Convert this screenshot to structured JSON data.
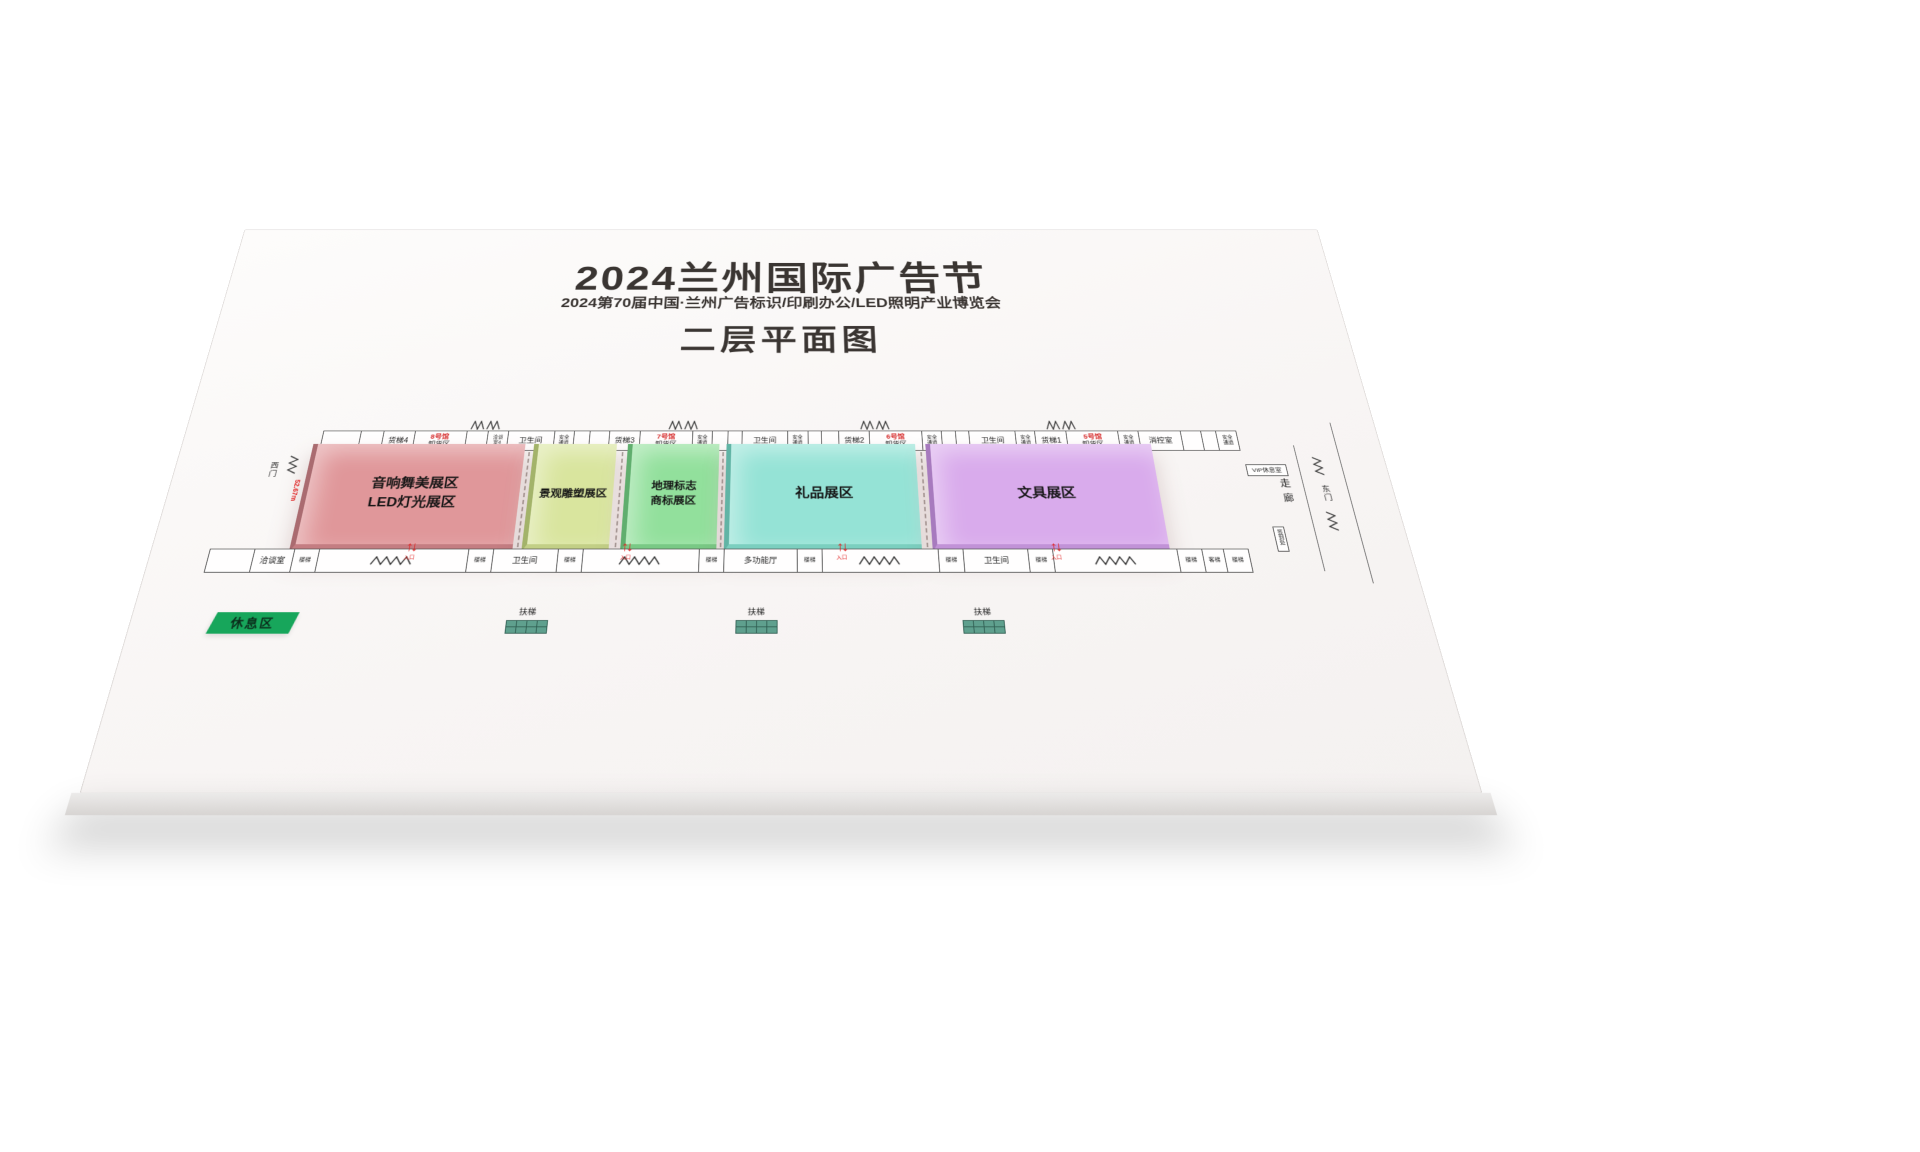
{
  "header": {
    "title": "2024兰州国际广告节",
    "subtitle": "2024第70届中国·兰州广告标识/印刷办公/LED照明产业博览会",
    "plan_title": "二层平面图"
  },
  "colors": {
    "hall_audio_red": "#e0979a",
    "hall_sculpture_yellow_green": "#d9e59e",
    "hall_geo_green": "#92e09c",
    "hall_gift_cyan": "#95e3d6",
    "hall_stationery_purple": "#d9abec",
    "accent_red": "#d62b2b",
    "rest_badge_green": "#17a65b",
    "escalator_teal": "#5fa08e",
    "board_white": "#fbf9f8"
  },
  "halls": [
    {
      "name_line1": "音响舞美展区",
      "name_line2": "LED灯光展区"
    },
    {
      "name_line1": "景观雕塑展区",
      "name_line2": ""
    },
    {
      "name_line1": "地理标志",
      "name_line2": "商标展区"
    },
    {
      "name_line1": "礼品展区",
      "name_line2": ""
    },
    {
      "name_line1": "文具展区",
      "name_line2": ""
    }
  ],
  "top_row": [
    {
      "l1": "",
      "l2": ""
    },
    {
      "l1": "",
      "l2": ""
    },
    {
      "l1": "货梯4",
      "l2": ""
    },
    {
      "l1": "8号馆",
      "l2": "卸货区"
    },
    {
      "l1": "",
      "l2": ""
    },
    {
      "l1": "洽谈",
      "l2": "室4"
    },
    {
      "l1": "卫生间",
      "l2": ""
    },
    {
      "l1": "安全",
      "l2": "通道"
    },
    {
      "l1": "",
      "l2": ""
    },
    {
      "l1": "",
      "l2": ""
    },
    {
      "l1": "货梯3",
      "l2": ""
    },
    {
      "l1": "7号馆",
      "l2": "卸货区"
    },
    {
      "l1": "安全",
      "l2": "通道"
    },
    {
      "l1": "",
      "l2": ""
    },
    {
      "l1": "",
      "l2": ""
    },
    {
      "l1": "卫生间",
      "l2": ""
    },
    {
      "l1": "安全",
      "l2": "通道"
    },
    {
      "l1": "",
      "l2": ""
    },
    {
      "l1": "",
      "l2": ""
    },
    {
      "l1": "货梯2",
      "l2": ""
    },
    {
      "l1": "6号馆",
      "l2": "卸货区"
    },
    {
      "l1": "安全",
      "l2": "通道"
    },
    {
      "l1": "",
      "l2": ""
    },
    {
      "l1": "",
      "l2": ""
    },
    {
      "l1": "卫生间",
      "l2": ""
    },
    {
      "l1": "安全",
      "l2": "通道"
    },
    {
      "l1": "货梯1",
      "l2": ""
    },
    {
      "l1": "5号馆",
      "l2": "卸货区"
    },
    {
      "l1": "安全",
      "l2": "通道"
    },
    {
      "l1": "消控室",
      "l2": ""
    },
    {
      "l1": "",
      "l2": ""
    },
    {
      "l1": "",
      "l2": ""
    },
    {
      "l1": "安全",
      "l2": "通道"
    }
  ],
  "bottom_row": [
    {
      "label": ""
    },
    {
      "label": "洽谈室"
    },
    {
      "label": "楼梯"
    },
    {
      "label": ""
    },
    {
      "label": "楼梯"
    },
    {
      "label": "卫生间"
    },
    {
      "label": "楼梯"
    },
    {
      "label": ""
    },
    {
      "label": "楼梯"
    },
    {
      "label": "多功能厅"
    },
    {
      "label": "楼梯"
    },
    {
      "label": ""
    },
    {
      "label": "楼梯"
    },
    {
      "label": "卫生间"
    },
    {
      "label": "楼梯"
    },
    {
      "label": ""
    },
    {
      "label": "楼梯"
    },
    {
      "label": "客梯"
    },
    {
      "label": "楼梯"
    }
  ],
  "sides": {
    "west_gate": "西门",
    "east_gate": "东门",
    "corridor": "走廊",
    "dimension": "52.67m",
    "vip_room": "VIP休息室",
    "sign_in": "签到处"
  },
  "footer": {
    "rest_area": "休息区",
    "escalator": "扶梯",
    "entrance_caption": "入口"
  }
}
